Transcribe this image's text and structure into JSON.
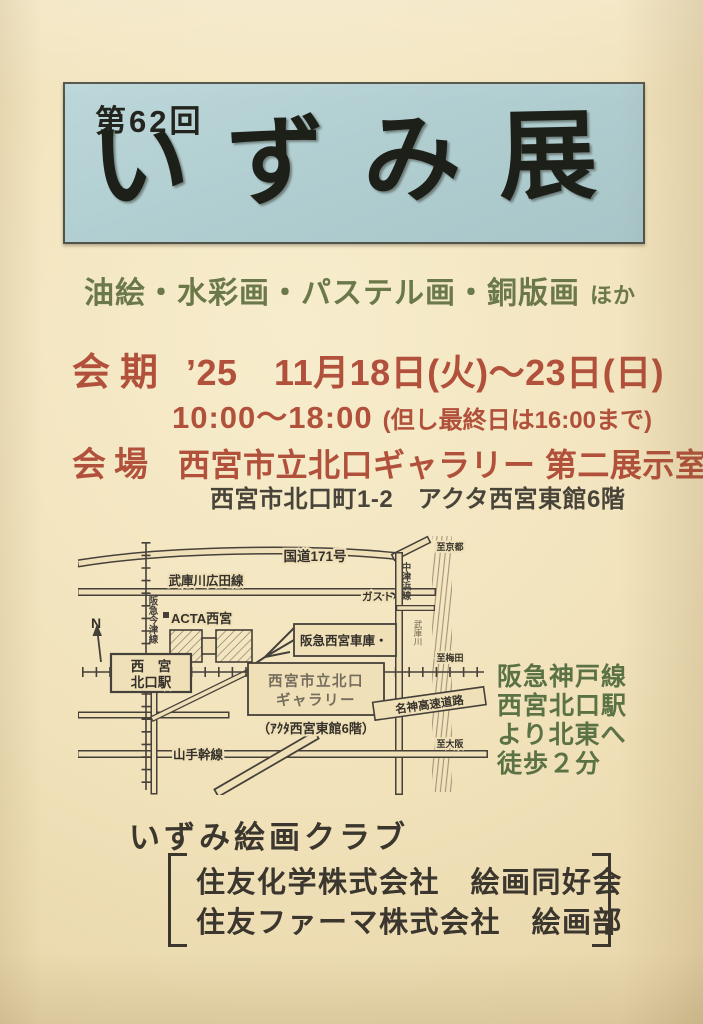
{
  "colors": {
    "paper": "#f0e1ba",
    "banner_blue": "#b1ced1",
    "ink": "#1d1f19",
    "accent_red": "#b1503b",
    "accent_green": "#6b7849",
    "map_ink": "#433e35"
  },
  "banner": {
    "edition": "第62回",
    "title": "いずみ展"
  },
  "media": {
    "text": "油絵・水彩画・パステル画・銅版画",
    "suffix": "ほか"
  },
  "schedule": {
    "label": "会期",
    "dates": "’25　11月18日(火)～23日(日)",
    "hours": "10:00～18:00",
    "hours_note": "(但し最終日は16:00まで)"
  },
  "venue": {
    "label": "会場",
    "name": "西宮市立北口ギャラリー 第二展示室",
    "address": "西宮市北口町1-2　アクタ西宮東館6階"
  },
  "access": {
    "lines": [
      "阪急神戸線",
      "西宮北口駅",
      "より北東へ",
      "徒歩２分"
    ]
  },
  "map": {
    "route_171": "国道171号",
    "hirota_line": "武庫川広田線",
    "imazu_line": "阪急今津線",
    "compass_n": "N",
    "station_line1": "西　宮",
    "station_line2": "北口駅",
    "acta": "ACTA西宮",
    "depot": "阪急西宮車庫・",
    "gusto": "ガスト",
    "nakatsuhama_line": "中津浜線",
    "mukogawa_river": "武庫川",
    "to_kyoto": "至京都",
    "to_umeda": "至梅田",
    "to_osaka": "至大阪",
    "gallery_line1": "西宮市立北口",
    "gallery_line2": "ギャラリー",
    "gallery_floor_note": "（ｱｸﾀ西宮東館6階）",
    "meishin_expressway": "名神高速道路",
    "yamate_line": "山手幹線"
  },
  "organizer": {
    "club": "いずみ絵画クラブ",
    "groups": [
      "住友化学株式会社　絵画同好会",
      "住友ファーマ株式会社　絵画部"
    ]
  }
}
